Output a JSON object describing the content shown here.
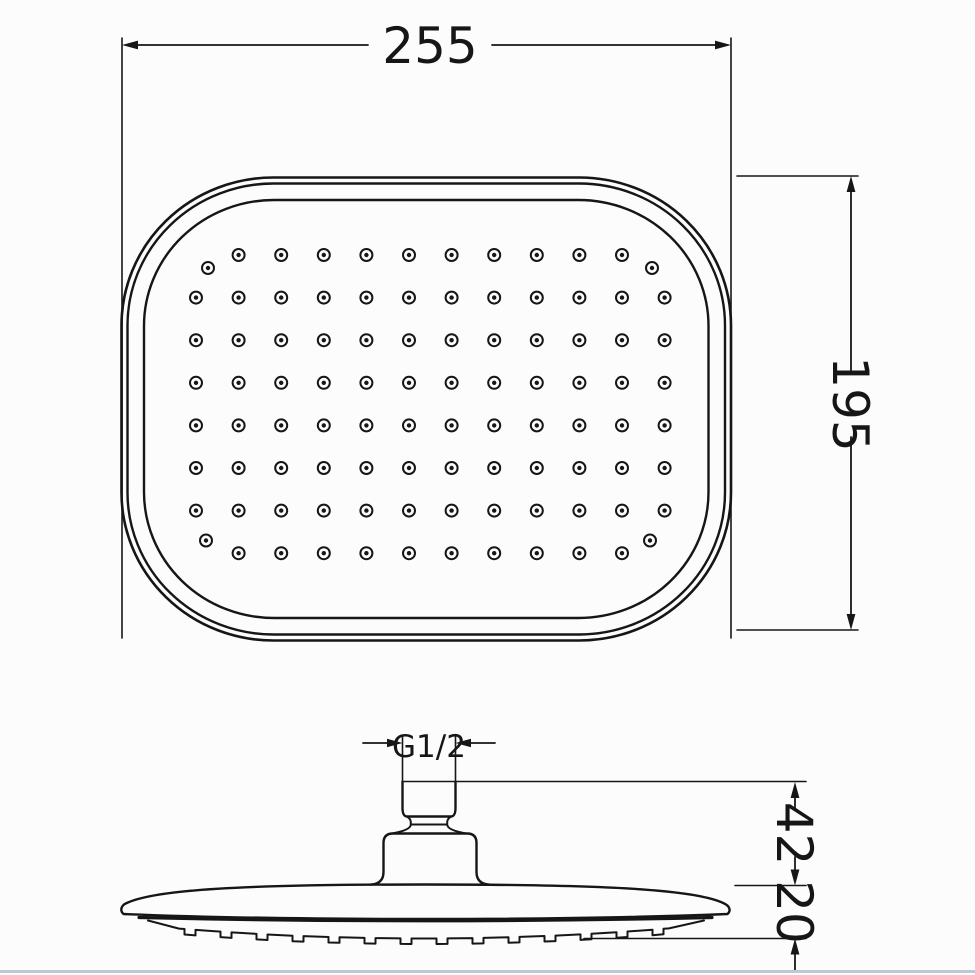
{
  "drawing": {
    "kind": "shower-head technical drawing",
    "colors": {
      "line": "#161616",
      "background": "#fcfcfc",
      "baseline": "#bcc8d2"
    },
    "dimensions": {
      "width_mm": "255",
      "height_mm": "195",
      "thread_size": "G1/2",
      "connector_height_mm": "42",
      "head_thickness_mm": "20"
    },
    "nozzles": {
      "rows": 8,
      "cols": 12,
      "row_start": 255,
      "col_start": 196,
      "spacing": 42.6,
      "edge_rows_inset_by_one_col": true,
      "corner_dots": [
        [
          208,
          268
        ],
        [
          652,
          268
        ],
        [
          206,
          540.5
        ],
        [
          650,
          540.5
        ]
      ],
      "outer_radius": 6,
      "outer_stroke": 2,
      "inner_radius": 2.2
    },
    "spray_ticks": {
      "count": 14,
      "x_start": 190,
      "x_end": 658,
      "tick_width": 11,
      "tick_depth": 5.5,
      "curve_center_x": 423,
      "curve_center_y": 938.5,
      "curve_half_span": 268,
      "curve_sag": 12,
      "path_left_x": 148,
      "path_right_x": 704,
      "path_edge_y": 920.5
    }
  }
}
